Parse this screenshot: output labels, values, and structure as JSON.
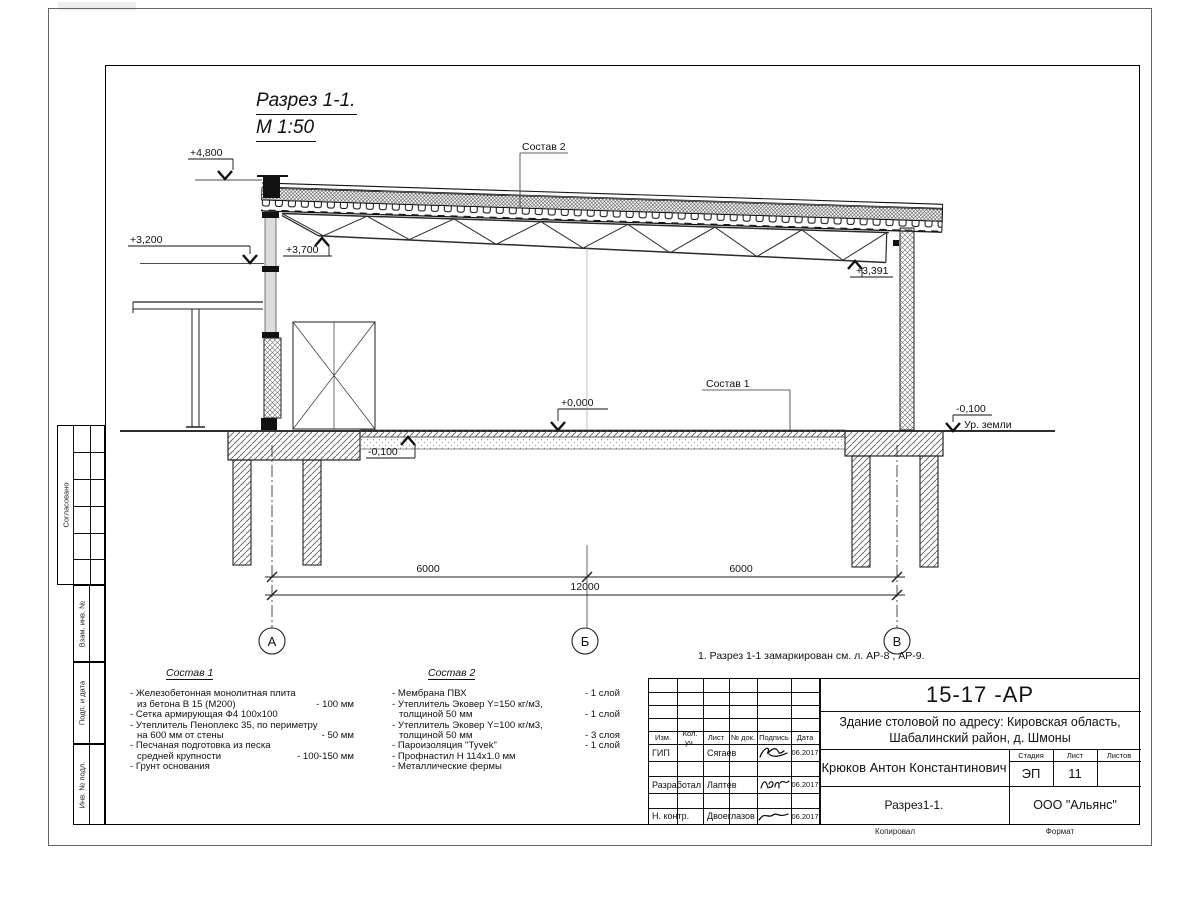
{
  "view": {
    "title": "Разрез 1-1.",
    "scale": "М 1:50",
    "note": "1. Разрез 1-1 замаркирован см. л. АР-8 , АР-9."
  },
  "elevations": {
    "p4800": "+4,800",
    "p3200": "+3,200",
    "p3700": "+3,700",
    "p3391": "+3,391",
    "zero": "+0,000",
    "m100_floor": "-0,100",
    "m100_ground": "-0,100",
    "ground_label": "Ур. земли"
  },
  "leaders": {
    "sostav1": "Состав 1",
    "sostav2": "Состав 2"
  },
  "dimensions": {
    "left": "6000",
    "right": "6000",
    "total": "12000"
  },
  "axes": {
    "a": "А",
    "b": "Б",
    "v": "В"
  },
  "sostav1": {
    "title": "Состав 1",
    "lines": [
      {
        "t": "- Железобетонная  монолитная плита",
        "v": ""
      },
      {
        "t": "из бетона В 15 (М200)",
        "v": "- 100 мм"
      },
      {
        "t": "- Сетка армирующая Ф4 100x100",
        "v": ""
      },
      {
        "t": "- Утеплитель Пеноплекс 35, по периметру",
        "v": ""
      },
      {
        "t": "на 600 мм от стены",
        "v": "- 50 мм"
      },
      {
        "t": "- Песчаная подготовка из песка",
        "v": ""
      },
      {
        "t": "средней крупности",
        "v": "- 100-150 мм"
      },
      {
        "t": "- Грунт основания",
        "v": ""
      }
    ]
  },
  "sostav2": {
    "title": "Состав 2",
    "lines": [
      {
        "t": "- Мембрана ПВХ",
        "v": "- 1 слой"
      },
      {
        "t": "- Утеплитель Эковер Y=150 кг/м3,",
        "v": ""
      },
      {
        "t": "толщиной 50 мм",
        "v": "- 1 слой"
      },
      {
        "t": "- Утеплитель Эковер Y=100 кг/м3,",
        "v": ""
      },
      {
        "t": "толщиной 50 мм",
        "v": "- 3 слоя"
      },
      {
        "t": "- Пароизоляция \"Tyvek\"",
        "v": "- 1 слой"
      },
      {
        "t": "- Профнастил Н 114x1.0 мм",
        "v": ""
      },
      {
        "t": "- Металлические фермы",
        "v": ""
      }
    ]
  },
  "stamp_left": {
    "sogl": "Согласовано",
    "vzam": "Взам. инв. №",
    "podp": "Подп. и дата",
    "inv": "Инв. № подл."
  },
  "titleblock": {
    "code": "15-17 -АР",
    "project_line1": "Здание столовой по адресу: Кировская область,",
    "project_line2": "Шабалинский район, д. Шмоны",
    "person": "Крюков Антон Константинович",
    "drawing_name": "Разрез1-1.",
    "company": "ООО \"Альянс\"",
    "stage_label": "Стадия",
    "sheet_label": "Лист",
    "sheets_label": "Листов",
    "stage": "ЭП",
    "sheet": "11",
    "sheets": "",
    "cols": {
      "izm": "Изм.",
      "kol": "Кол. уч.",
      "list": "Лист",
      "ndok": "№ док.",
      "podpis": "Подпись",
      "data": "Дата"
    },
    "rows": [
      {
        "role": "ГИП",
        "name": "Сягаев",
        "date": "06.2017"
      },
      {
        "role": "Разработал",
        "name": "Лаптев",
        "date": "06.2017"
      },
      {
        "role": "Н. контр.",
        "name": "Двоеглазов",
        "date": "06.2017"
      }
    ],
    "kopiroval": "Копировал",
    "format": "Формат"
  }
}
